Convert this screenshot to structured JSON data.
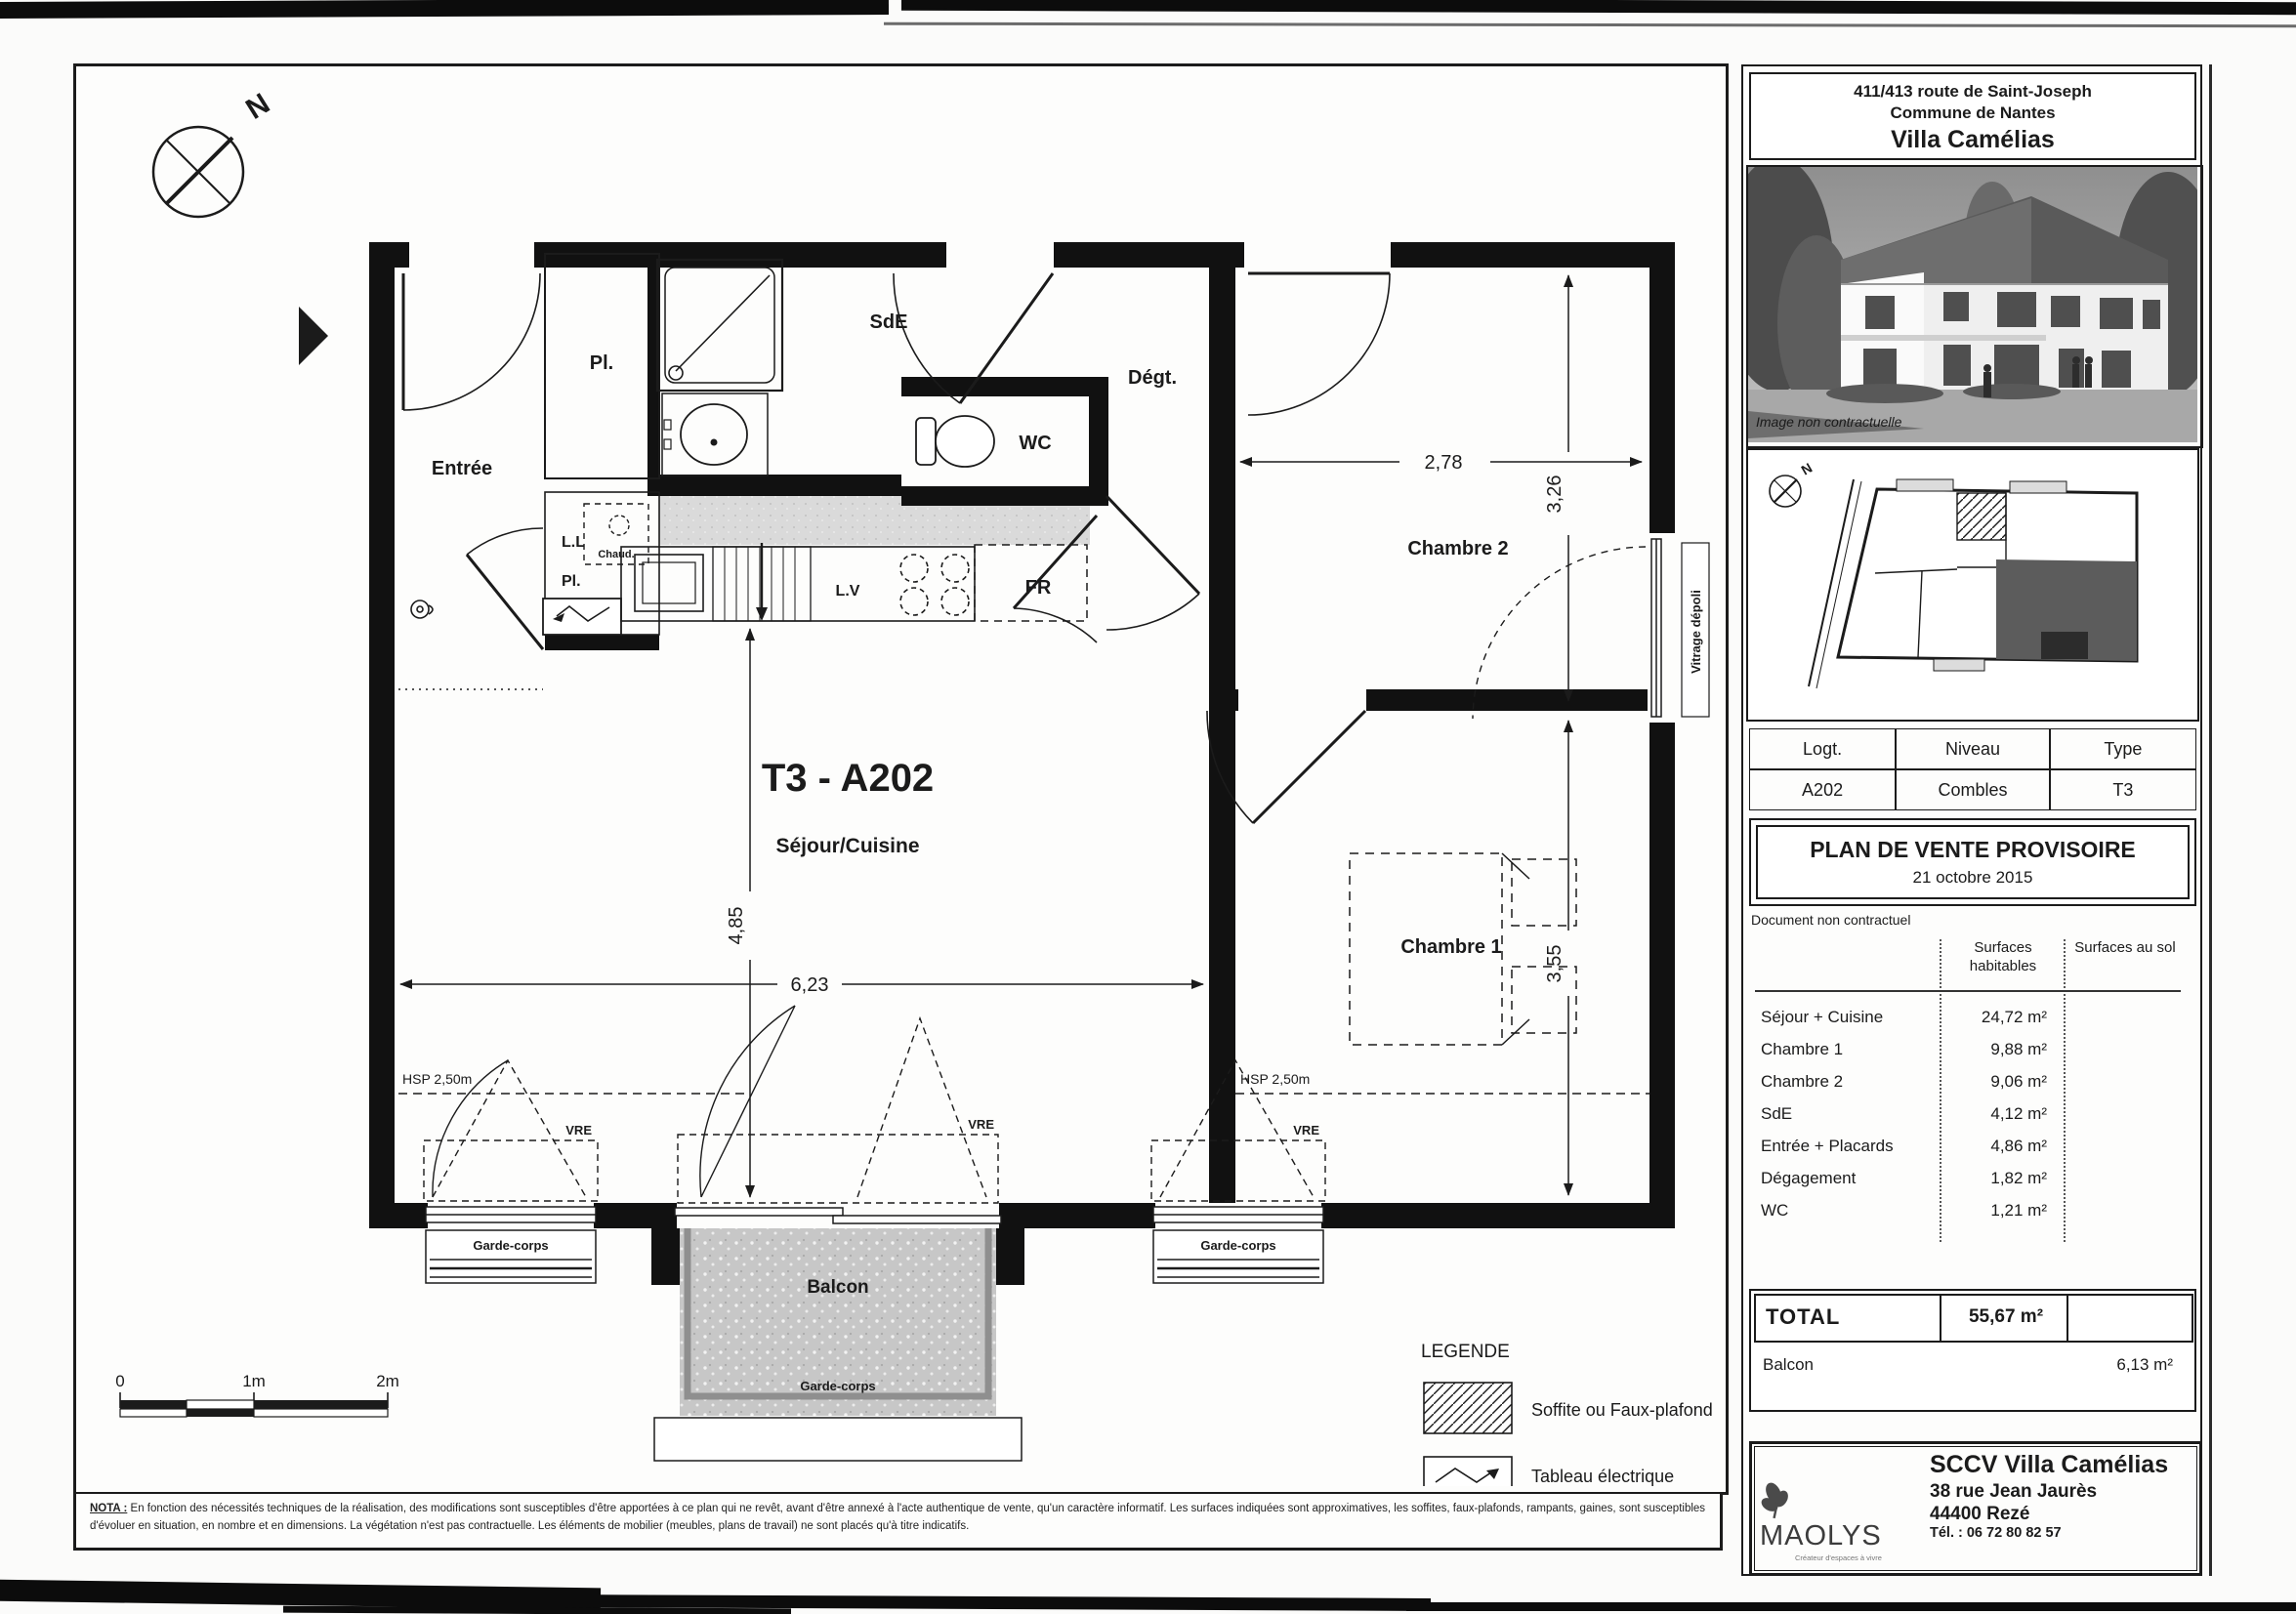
{
  "plan": {
    "title": "T3 - A202",
    "subtitle": "Séjour/Cuisine",
    "rooms": {
      "entree": "Entrée",
      "pl_top": "Pl.",
      "sde": "SdE",
      "wc": "WC",
      "degt": "Dégt.",
      "chambre2": "Chambre 2",
      "chambre1": "Chambre 1",
      "balcon": "Balcon",
      "ll": "L.L",
      "chaud": "Chaud.",
      "pl_bottom": "Pl.",
      "lv": "L.V",
      "fr": "FR"
    },
    "dims": {
      "chambre2_width": "2,78",
      "chambre2_height": "3,26",
      "sejour_height": "4,85",
      "sejour_width": "6,23",
      "chambre1_height": "3,55"
    },
    "annotations": {
      "hsp": "HSP 2,50m",
      "vre": "VRE",
      "garde_corps": "Garde-corps",
      "vitrage_depoli": "Vitrage dépoli",
      "north": "N"
    },
    "scalebar": {
      "t0": "0",
      "t1": "1m",
      "t2": "2m"
    },
    "legend": {
      "title": "LEGENDE",
      "soffite": "Soffite ou Faux-plafond",
      "tableau": "Tableau électrique"
    },
    "nota_label": "NOTA :",
    "nota_line1": "En fonction des nécessités techniques de la réalisation, des modifications sont susceptibles d'être apportées à ce plan qui ne revêt, avant d'être annexé à l'acte authentique de vente, qu'un caractère informatif. Les surfaces indiquées sont approximatives, les soffites, faux-plafonds, rampants,",
    "nota_line2": "gaines, sont susceptibles d'évoluer en situation, en nombre et en dimensions. La végétation n'est pas contractuelle. Les éléments de mobilier (meubles, plans de travail) ne sont placés qu'à titre indicatifs."
  },
  "sidebar": {
    "address_line1": "411/413 route de Saint-Joseph",
    "address_line2": "Commune de Nantes",
    "project": "Villa Camélias",
    "photo_caption": "Image non contractuelle",
    "north": "N",
    "unit_table": {
      "col1_header": "Logt.",
      "col2_header": "Niveau",
      "col3_header": "Type",
      "col1_value": "A202",
      "col2_value": "Combles",
      "col3_value": "T3"
    },
    "sale_title": "PLAN DE VENTE PROVISOIRE",
    "sale_date": "21 octobre 2015",
    "disclaimer": "Document non contractuel",
    "surfaces": {
      "header_hab": "Surfaces habitables",
      "header_sol": "Surfaces au sol",
      "rows": [
        {
          "label": "Séjour + Cuisine",
          "value": "24,72 m²"
        },
        {
          "label": "Chambre 1",
          "value": "9,88 m²"
        },
        {
          "label": "Chambre 2",
          "value": "9,06 m²"
        },
        {
          "label": "SdE",
          "value": "4,12 m²"
        },
        {
          "label": "Entrée + Placards",
          "value": "4,86 m²"
        },
        {
          "label": "Dégagement",
          "value": "1,82 m²"
        },
        {
          "label": "WC",
          "value": "1,21 m²"
        }
      ]
    },
    "total_label": "TOTAL",
    "total_value": "55,67 m²",
    "balcon_label": "Balcon",
    "balcon_value": "6,13 m²",
    "footer": {
      "logo": "MAOLYS",
      "tagline": "Créateur d'espaces à vivre",
      "company": "SCCV Villa Camélias",
      "address1": "38 rue Jean Jaurès",
      "address2": "44400 Rezé",
      "phone": "Tél. : 06 72 80 82 57"
    }
  },
  "colors": {
    "ink": "#1b1b1b",
    "soffite_gray": "#d8d8d8",
    "balcony_gray": "#c7c7c7"
  }
}
